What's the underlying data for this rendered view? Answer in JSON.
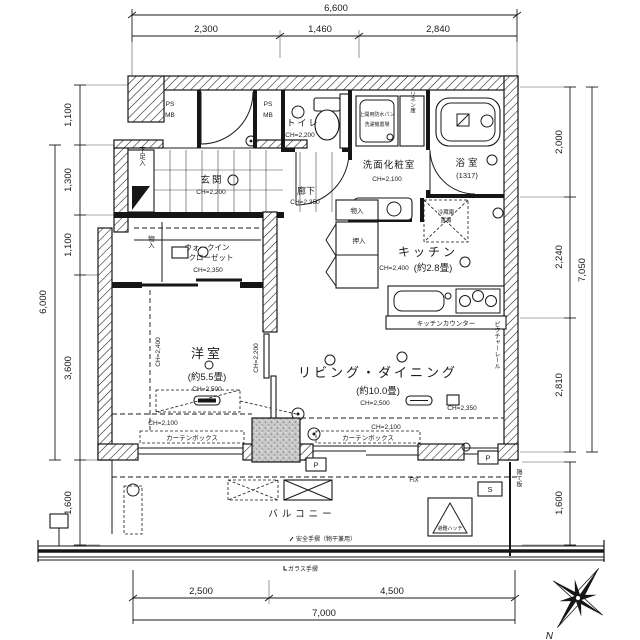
{
  "dims": {
    "top_total": "6,600",
    "top_segs": [
      "2,300",
      "1,460",
      "2,840"
    ],
    "bottom_total": "7,000",
    "bottom_segs": [
      "2,500",
      "4,500"
    ],
    "left_overall": "6,000",
    "left_segs": [
      "1,100",
      "1,300",
      "1,100",
      "3,600"
    ],
    "left_balcony": "1,600",
    "right_overall": "7,050",
    "right_segs": [
      "2,000",
      "2,240",
      "2,810"
    ],
    "right_balcony": "1,600"
  },
  "rooms": {
    "entrance": {
      "name": "玄関",
      "ch": "CH=2,200"
    },
    "hallway": {
      "name": "廊下",
      "ch": "CH=2,350"
    },
    "toilet": {
      "name": "トイレ",
      "ch": "CH=2,200"
    },
    "powder": {
      "name": "洗面化粧室",
      "ch": "CH=2,100"
    },
    "bath": {
      "name": "浴室",
      "size": "(1317)"
    },
    "kitchen": {
      "name": "キッチン",
      "size": "(約2.8畳)",
      "ch": "CH=2,400"
    },
    "western": {
      "name": "洋室",
      "size": "(約5.5畳)",
      "ch": "CH=2,500",
      "ch_side": "CH=2,400",
      "ch_low": "CH=2,100"
    },
    "living": {
      "name": "リビング・ダイニング",
      "size": "(約10.0畳)",
      "ch": "CH=2,500",
      "ch_side": "CH=2,350",
      "ch_low": "CH=2,100",
      "ch_wall": "CH=2,200"
    },
    "wic": {
      "line1": "ウォークイン",
      "line2": "クローゼット",
      "ch": "CH=2,350"
    },
    "balcony": {
      "name": "バルコニー"
    }
  },
  "labels": {
    "ps": "PS",
    "mb": "MB",
    "shoe": "下足入",
    "storage": "物入",
    "oshiire": "押入",
    "linen": "リネン庫",
    "washer1": "上開用防水パン",
    "washer2": "洗濯機置場",
    "fridge1": "冷蔵庫",
    "fridge2": "置場",
    "counter": "キッチンカウンター",
    "curtain": "カーテンボックス",
    "fix": "FIX",
    "p": "P",
    "s": "S",
    "hatch": "避難ハッチ",
    "safety": "安全手摺（物干兼用）",
    "glass": "ガラス手摺",
    "partition": "隔て板",
    "picture_rail": "ピクチャーレール",
    "north": "N"
  }
}
